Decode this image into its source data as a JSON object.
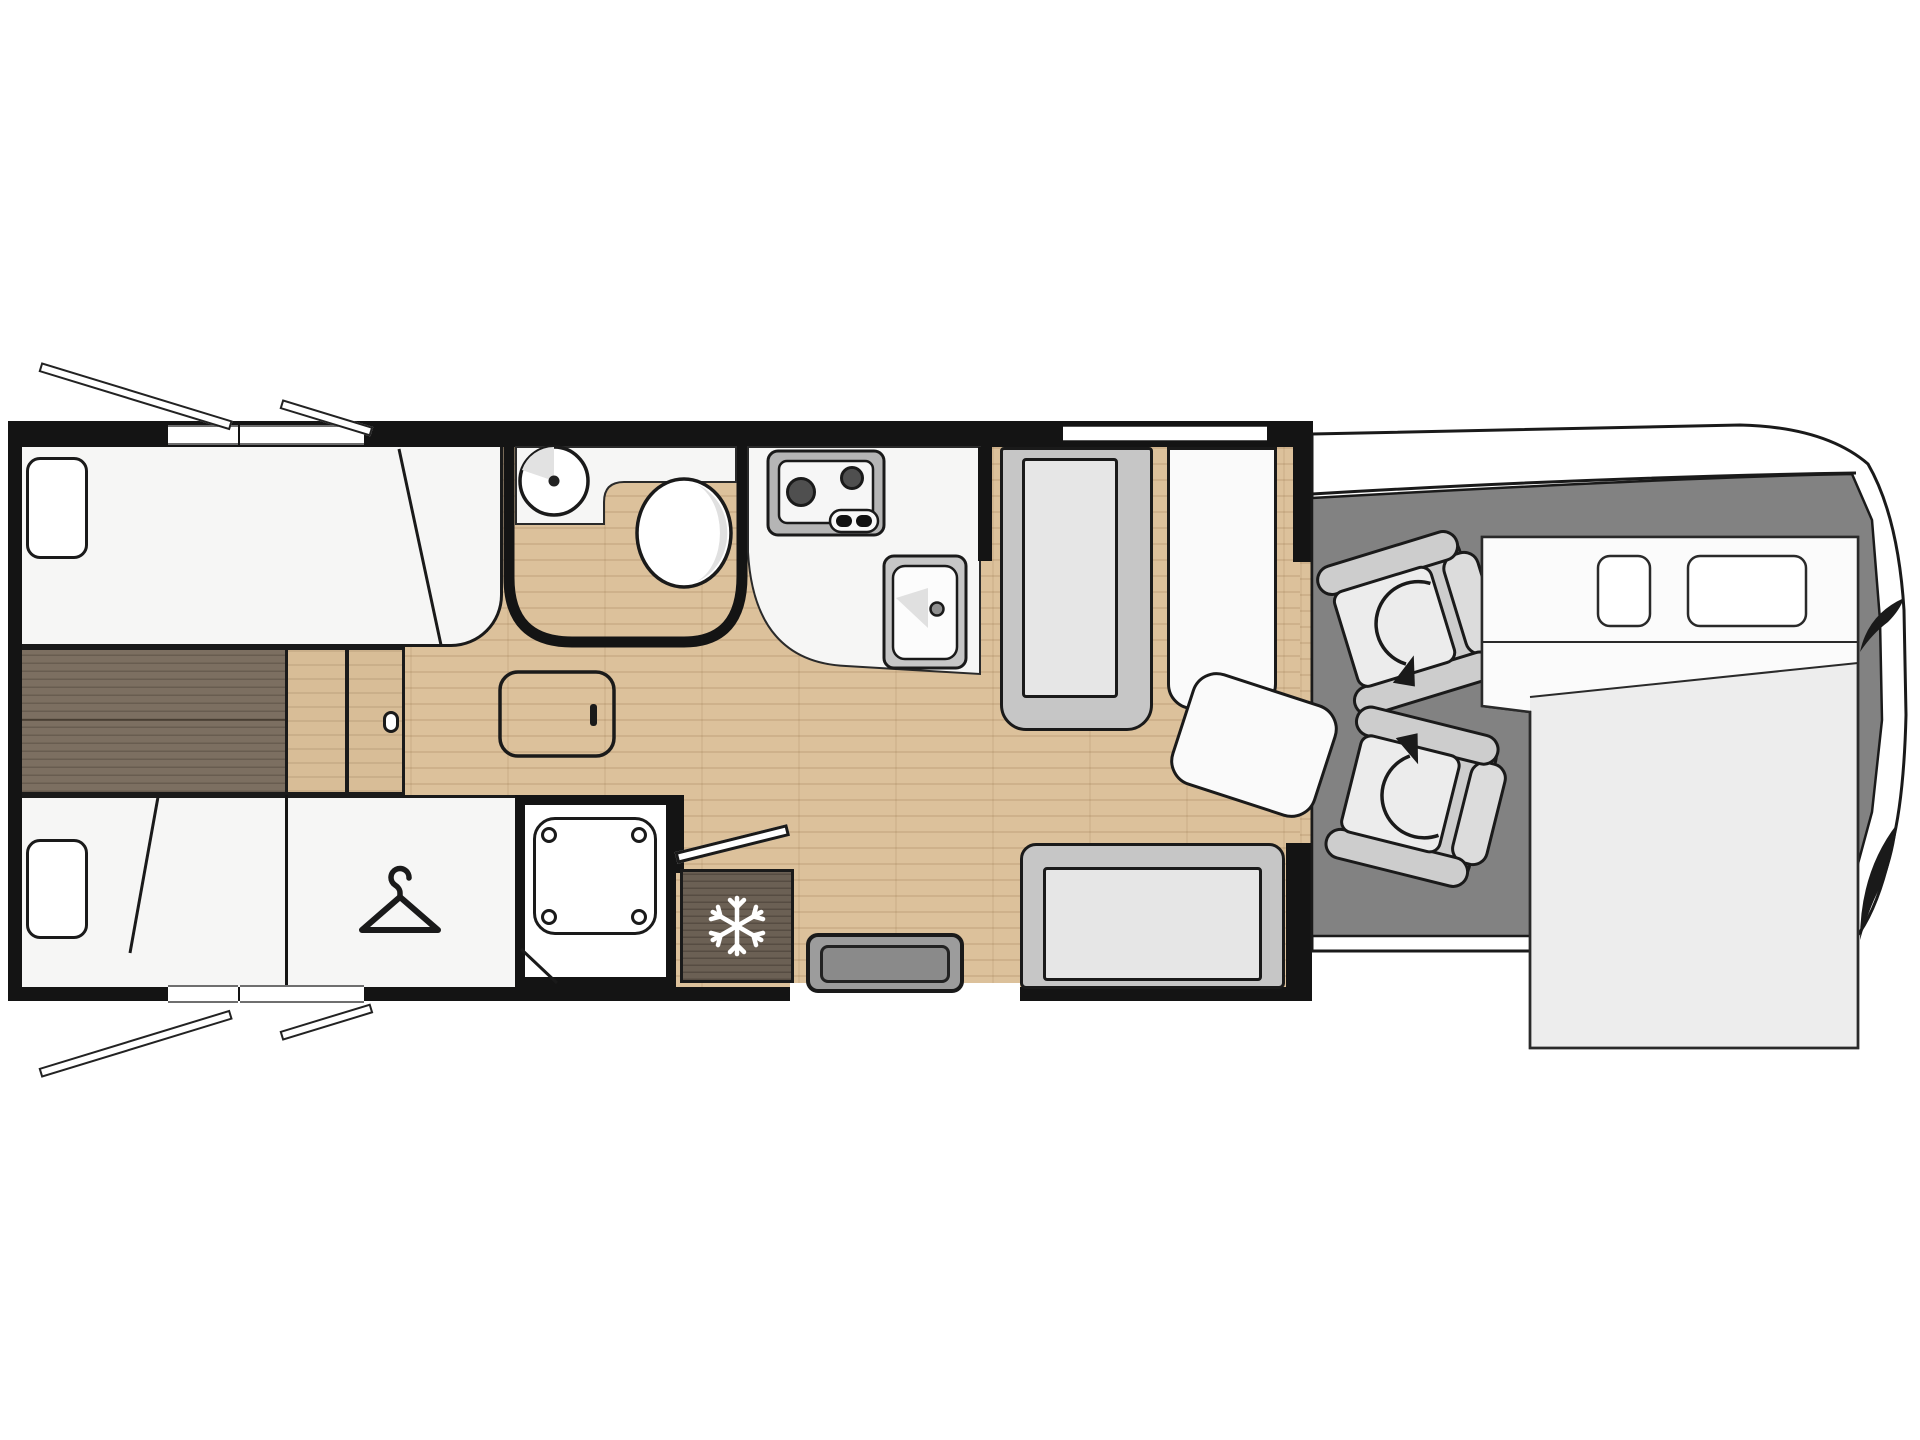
{
  "title": "",
  "diagram": {
    "kind": "motorhome-floorplan-top-view",
    "text_labels": [],
    "zones": {
      "rear_bedroom": {
        "items": [
          "twin-bed-top",
          "twin-bed-bottom",
          "pillow-top",
          "pillow-bottom",
          "center-walkway",
          "step-panel",
          "sliding-door",
          "door-handle"
        ]
      },
      "washroom": {
        "items": [
          "round-basin",
          "toilet",
          "vanity-counter",
          "curved-wall"
        ]
      },
      "kitchen": {
        "items": [
          "two-burner-hob",
          "hob-controls",
          "sink-with-drain",
          "counter",
          "tall-cabinet"
        ]
      },
      "mid_bathroom": {
        "items": [
          "shower-tray",
          "shower-screws"
        ]
      },
      "wardrobe": {
        "items": [
          "clothes-hanger"
        ]
      },
      "entrance": {
        "items": [
          "entry-door-leaf",
          "entry-step",
          "fridge-freezer"
        ]
      },
      "lounge": {
        "items": [
          "table",
          "side-sofa",
          "sofa-end",
          "forward-bench-seat",
          "rear-bench-seat"
        ]
      },
      "cab": {
        "items": [
          "driver-swivel-seat",
          "passenger-swivel-seat",
          "swivel-arrows",
          "windscreen-band",
          "cab-floor",
          "mirror-marks"
        ]
      },
      "front_bed": {
        "items": [
          "drop-down-bed",
          "bed-pillow-small",
          "bed-pillow-large",
          "duvet-edge"
        ]
      },
      "exterior": {
        "items": [
          "open-roof-hatch-flaps",
          "window-openings",
          "body-walls"
        ]
      }
    }
  },
  "icons": {
    "hanger-icon": "clothes-hanger",
    "snowflake-icon": "fridge-freezer",
    "rotation-arrow-icon": "seat-swivel-direction",
    "door-leaf-icon": "open-entry-door"
  },
  "colors": {
    "wall": "#141414",
    "line": "#1a1a1a",
    "floor": "#dcc19b",
    "wood-panel": "#d8bd97",
    "walkway": "#7c6f61",
    "room": "#f6f6f5",
    "fixture": "#c6c6c6",
    "fixture-light": "#e6e6e6",
    "cushion": "#ececec",
    "seat-trim": "#cdcdcd",
    "cab-floor": "#828282",
    "step": "#9c9c9c",
    "step-inner": "#8a8a8a",
    "mattress": "#ededed",
    "sheet": "#fbfbfb",
    "fridge": "#6b6054"
  }
}
